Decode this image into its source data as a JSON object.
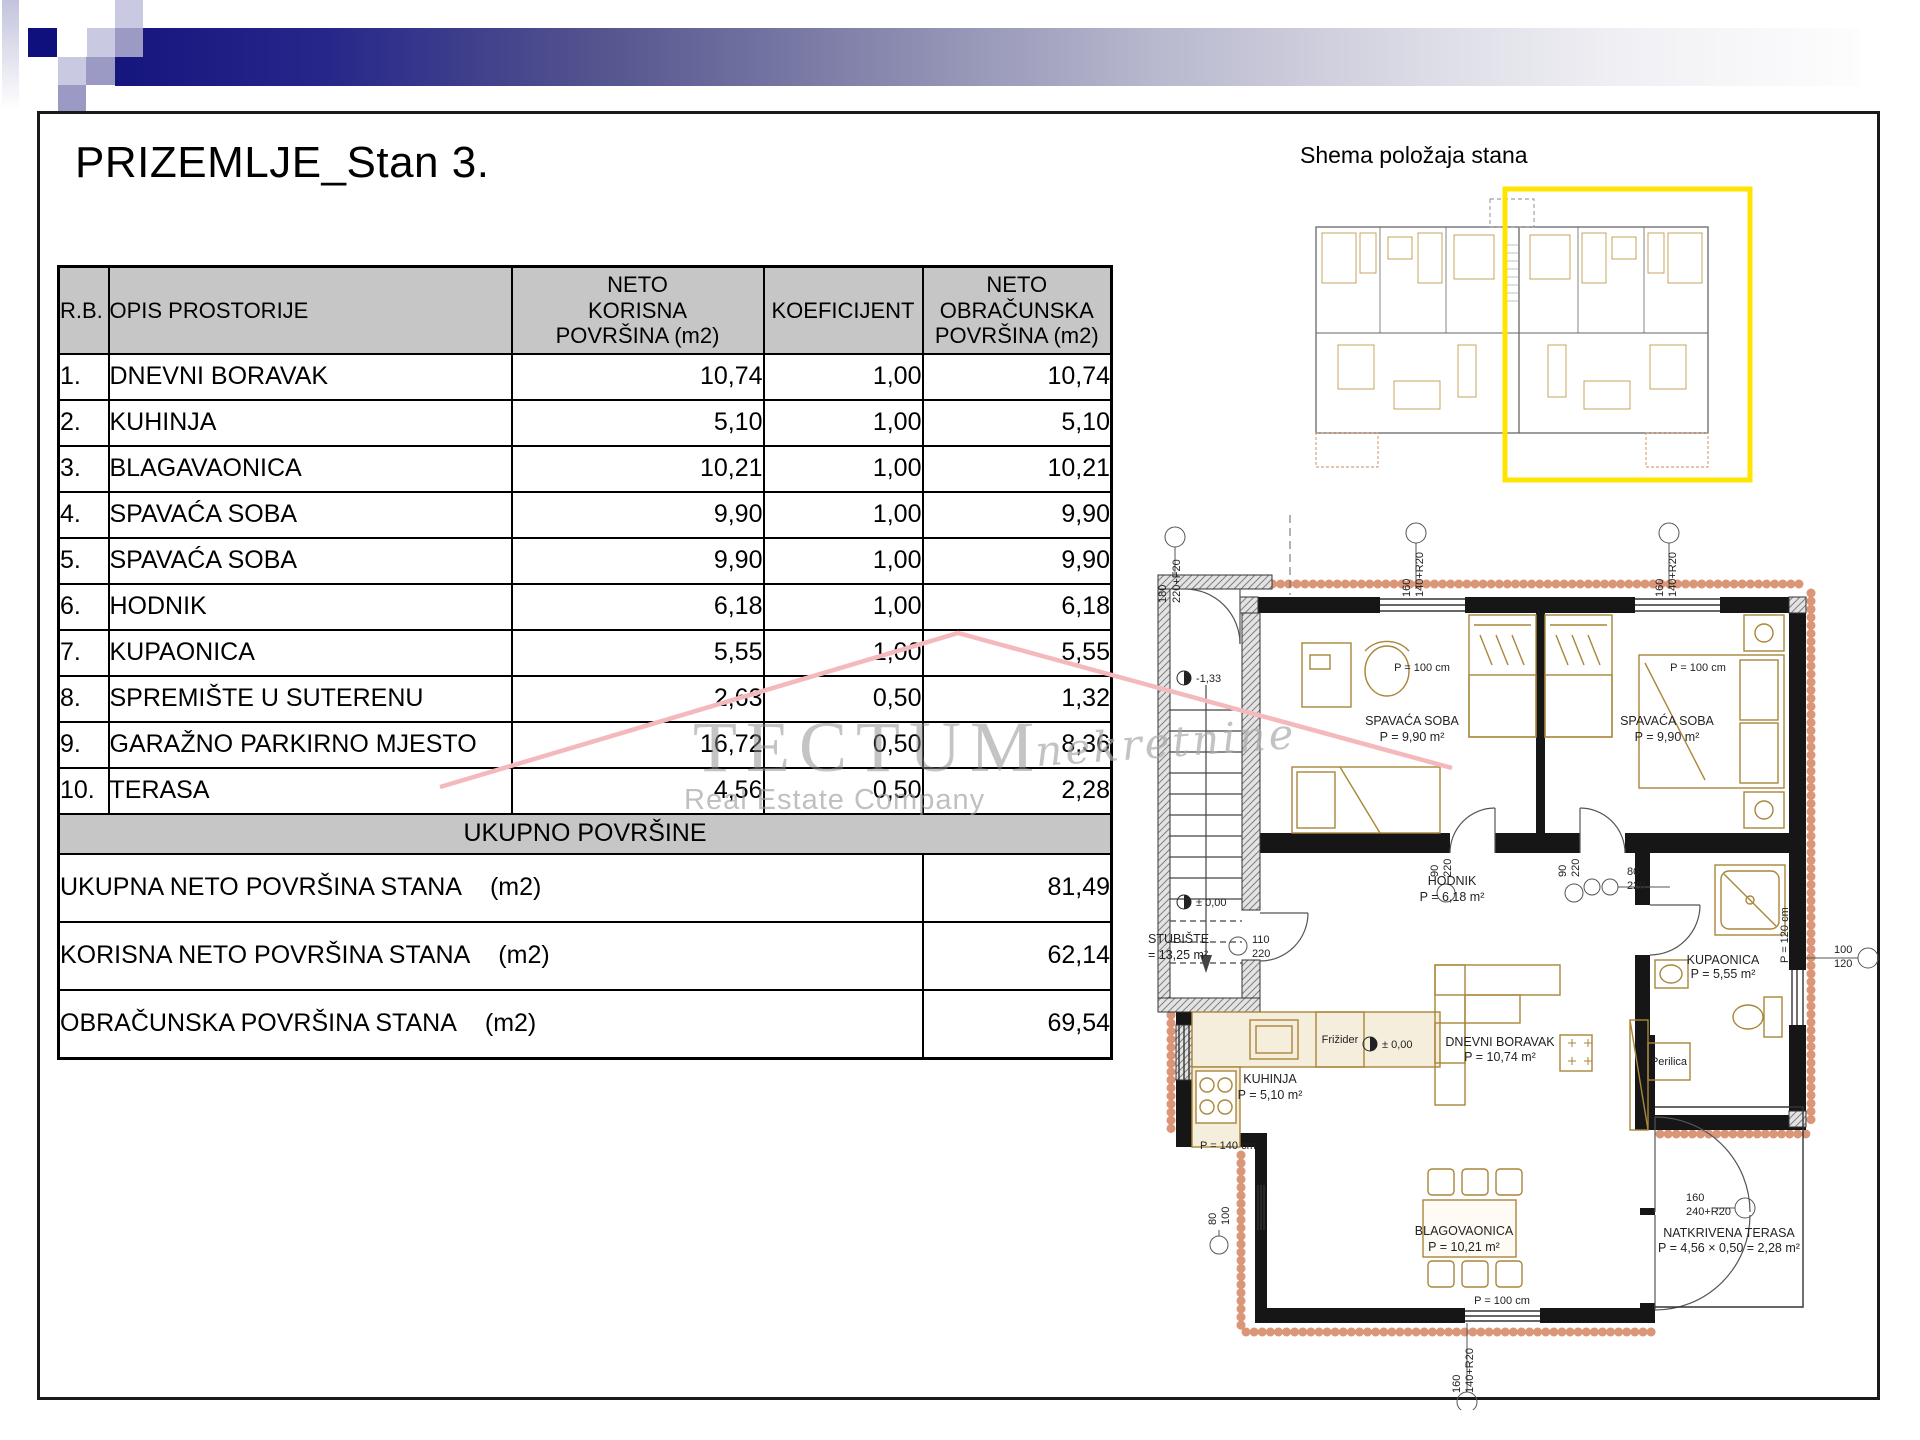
{
  "slide": {
    "title": "PRIZEMLJE_Stan 3."
  },
  "schema": {
    "title": "Shema položaja stana"
  },
  "table": {
    "headers": [
      "R.B.",
      "OPIS PROSTORIJE",
      "NETO\nKORISNA\nPOVRŠINA (m2)",
      "KOEFICIJENT",
      "NETO\nOBRAČUNSKA\nPOVRŠINA (m2)"
    ],
    "rows": [
      {
        "rb": "1.",
        "opis": "DNEVNI BORAVAK",
        "korisna": "10,74",
        "koef": "1,00",
        "obr": "10,74"
      },
      {
        "rb": "2.",
        "opis": "KUHINJA",
        "korisna": "5,10",
        "koef": "1,00",
        "obr": "5,10"
      },
      {
        "rb": "3.",
        "opis": "BLAGAVAONICA",
        "korisna": "10,21",
        "koef": "1,00",
        "obr": "10,21"
      },
      {
        "rb": "4.",
        "opis": "SPAVAĆA SOBA",
        "korisna": "9,90",
        "koef": "1,00",
        "obr": "9,90"
      },
      {
        "rb": "5.",
        "opis": "SPAVAĆA SOBA",
        "korisna": "9,90",
        "koef": "1,00",
        "obr": "9,90"
      },
      {
        "rb": "6.",
        "opis": "HODNIK",
        "korisna": "6,18",
        "koef": "1,00",
        "obr": "6,18"
      },
      {
        "rb": "7.",
        "opis": "KUPAONICA",
        "korisna": "5,55",
        "koef": "1,00",
        "obr": "5,55"
      },
      {
        "rb": "8.",
        "opis": "SPREMIŠTE U SUTERENU",
        "korisna": "2,63",
        "koef": "0,50",
        "obr": "1,32"
      },
      {
        "rb": "9.",
        "opis": "GARAŽNO PARKIRNO MJESTO",
        "korisna": "16,72",
        "koef": "0,50",
        "obr": "8,36"
      },
      {
        "rb": "10.",
        "opis": "TERASA",
        "korisna": "4,56",
        "koef": "0,50",
        "obr": "2,28"
      }
    ],
    "total_band": "UKUPNO POVRŠINE",
    "summary": [
      {
        "label": "UKUPNA NETO POVRŠINA STANA",
        "unit": "(m2)",
        "value": "81,49"
      },
      {
        "label": "KORISNA NETO POVRŠINA STANA",
        "unit": "(m2)",
        "value": "62,14"
      },
      {
        "label": "OBRAČUNSKA POVRŠINA STANA",
        "unit": "(m2)",
        "value": "69,54"
      }
    ]
  },
  "watermark": {
    "brand": "TECTUM",
    "script": "nekretnine",
    "subtitle": "Real Estate Company",
    "roof_color": "#f4b9bd"
  },
  "plan": {
    "rooms": [
      {
        "name": "SPAVAĆA SOBA",
        "area": "P = 9,90 m²"
      },
      {
        "name": "SPAVAĆA SOBA",
        "area": "P = 9,90 m²"
      },
      {
        "name": "HODNIK",
        "area": "P = 6,18 m²"
      },
      {
        "name": "KUPAONICA",
        "area": "P = 5,55 m²"
      },
      {
        "name": "KUHINJA",
        "area": "P = 5,10 m²"
      },
      {
        "name": "DNEVNI BORAVAK",
        "area": "P = 10,74 m²"
      },
      {
        "name": "BLAGOVAONICA",
        "area": "P = 10,21 m²"
      },
      {
        "name": "NATKRIVENA TERASA",
        "area": "P = 4,56 × 0,50 = 2,28 m²"
      },
      {
        "name": "STUBIŠTE",
        "area": "= 13,25 m²"
      }
    ],
    "appliances": {
      "fridge": "Frižider",
      "washer": "Perilica"
    },
    "levels": {
      "minus": "-1,33",
      "zero": "± 0,00"
    },
    "dims": {
      "d180": "180",
      "d220F": "220+F20",
      "d160": "160",
      "d140R": "140+R20",
      "p100": "P = 100 cm",
      "p140": "P = 140 cm",
      "p120": "P = 120 cm",
      "d90": "90",
      "d220": "220",
      "d80": "80",
      "d110": "110",
      "d100": "100",
      "d120": "120",
      "terasa_w": "160",
      "terasa_h": "240+R20"
    }
  }
}
